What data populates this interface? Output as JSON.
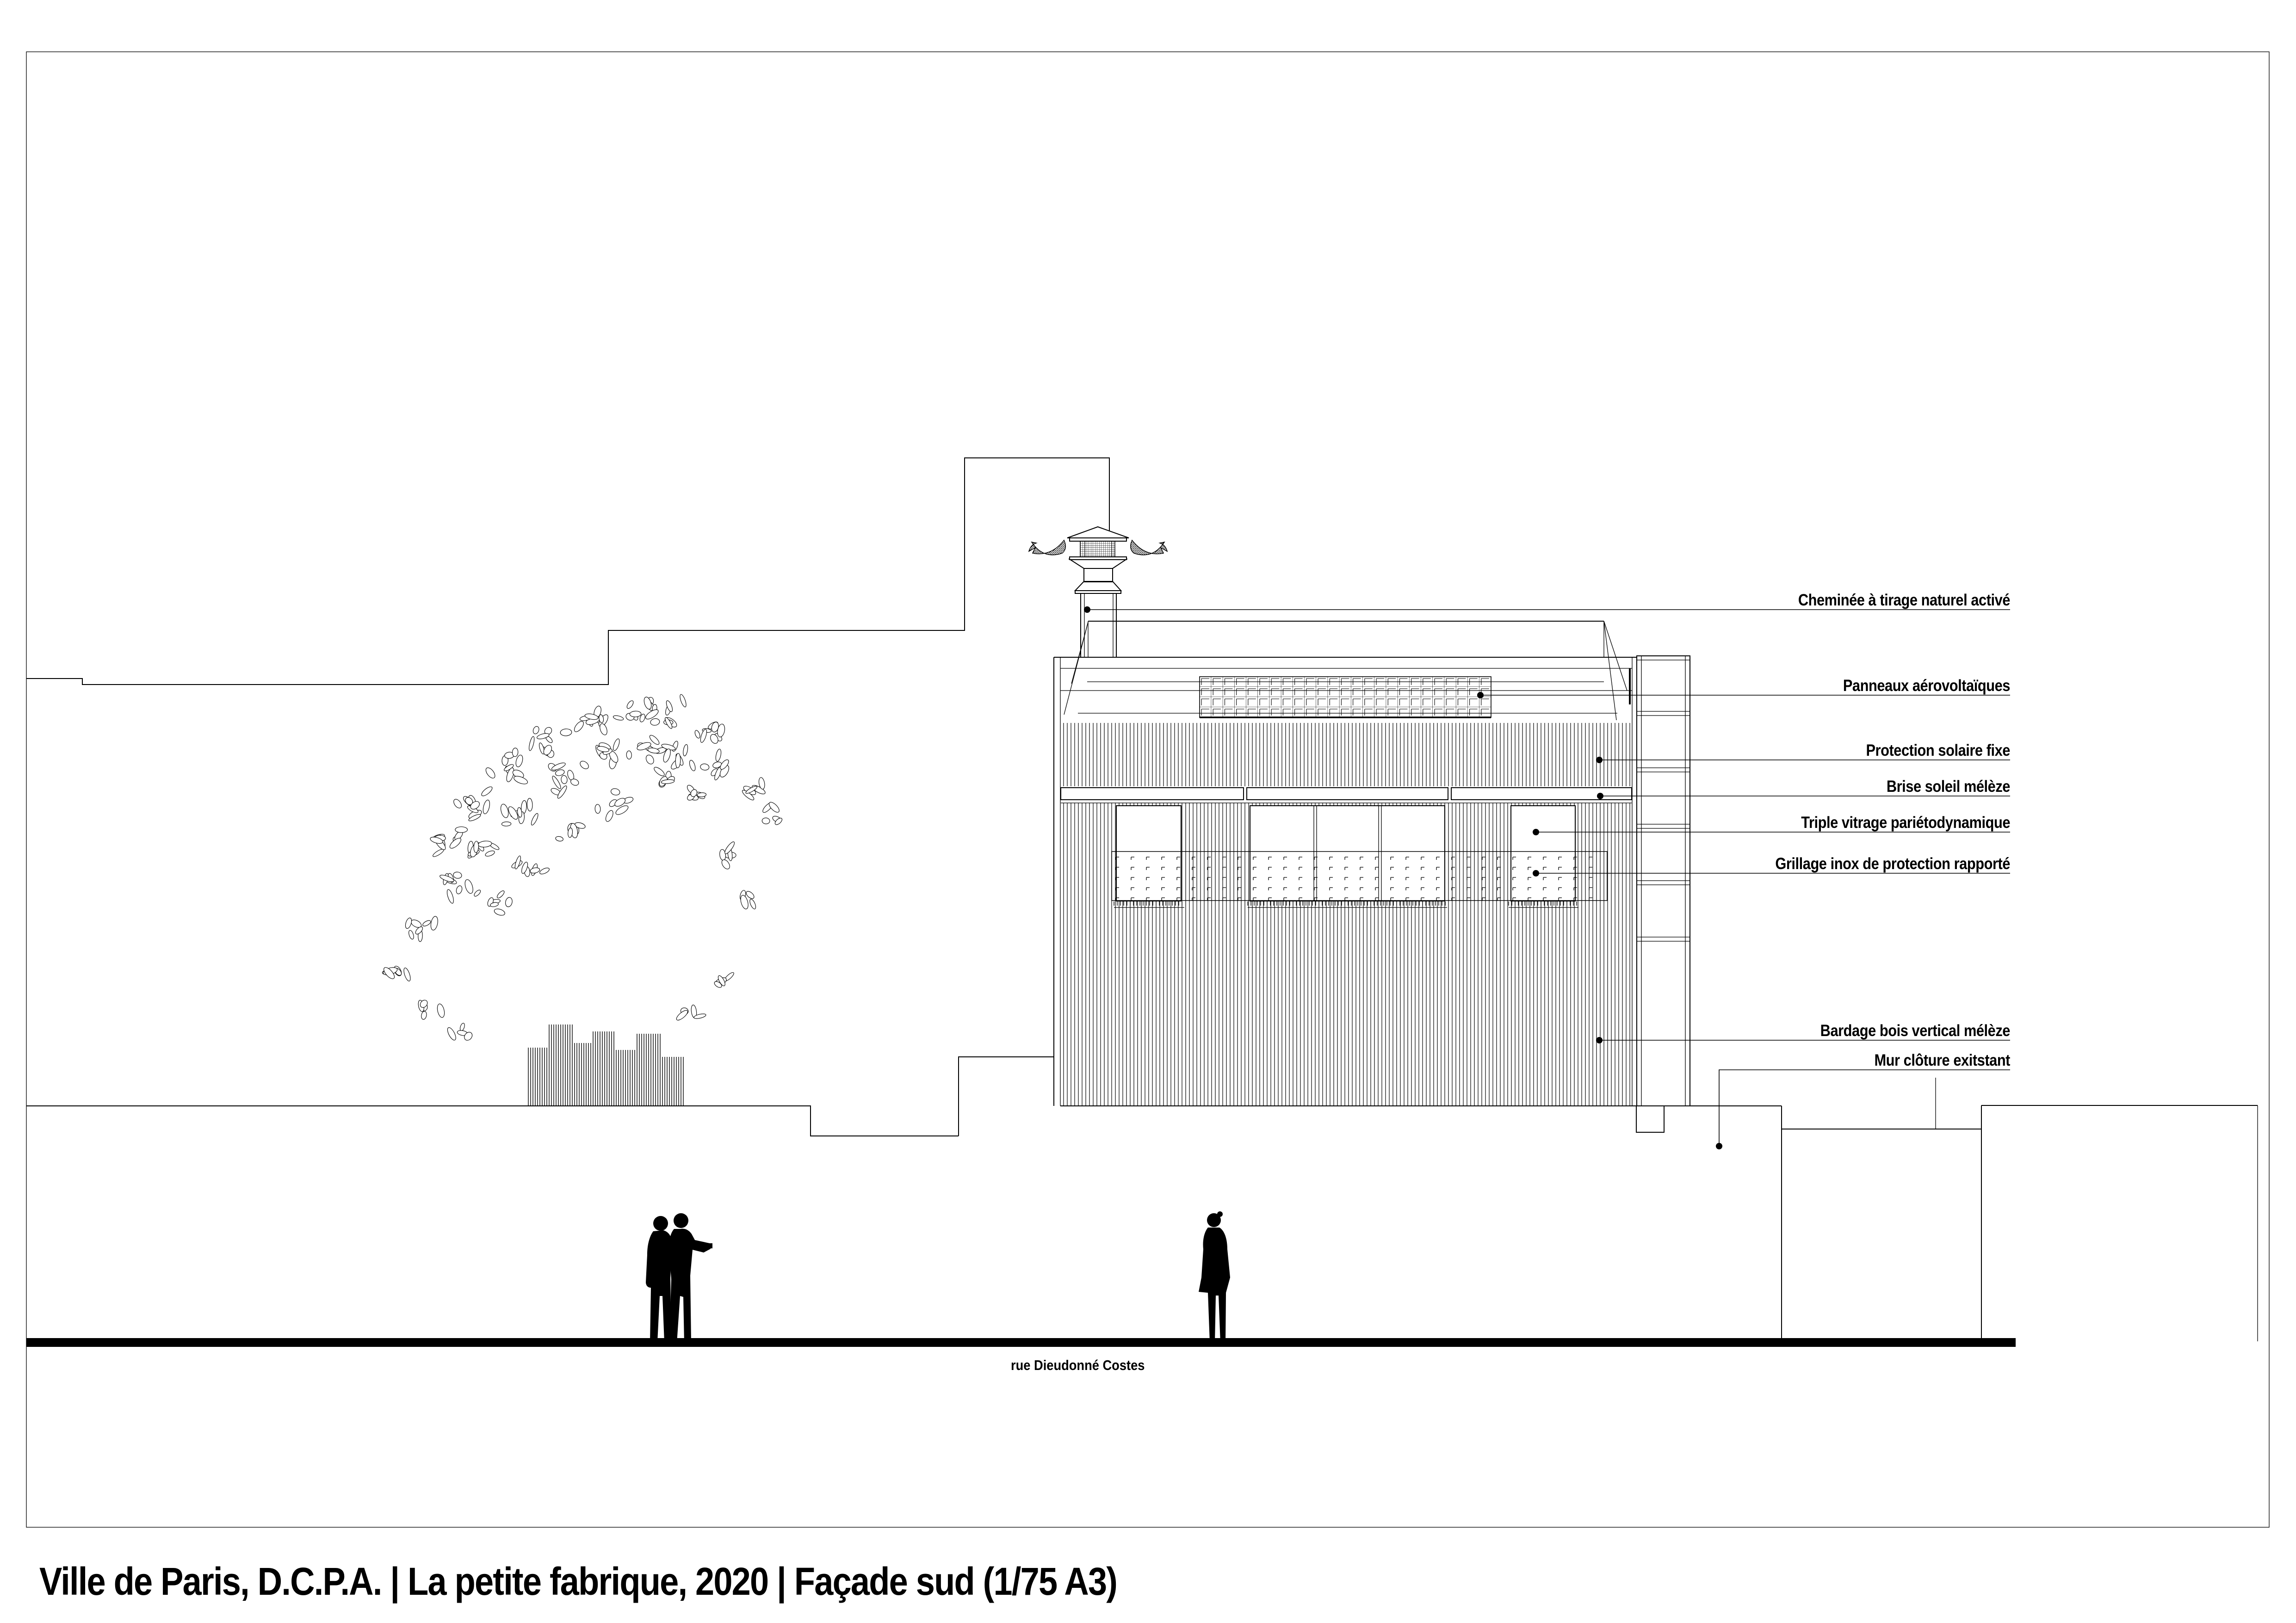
{
  "title": "Ville de Paris, D.C.P.A. | La petite fabrique, 2020 | Façade sud (1/75 A3)",
  "street_label": "rue Dieudonné Costes",
  "annotations": [
    {
      "label": "Cheminée à tirage naturel activé"
    },
    {
      "label": "Panneaux aérovoltaïques"
    },
    {
      "label": "Protection solaire fixe"
    },
    {
      "label": "Brise soleil mélèze"
    },
    {
      "label": "Triple vitrage pariétodynamique"
    },
    {
      "label": "Grillage inox de protection rapporté"
    },
    {
      "label": "Bardage bois vertical mélèze"
    },
    {
      "label": "Mur clôture exitstant"
    }
  ],
  "colors": {
    "line": "#000000",
    "background": "#ffffff"
  }
}
